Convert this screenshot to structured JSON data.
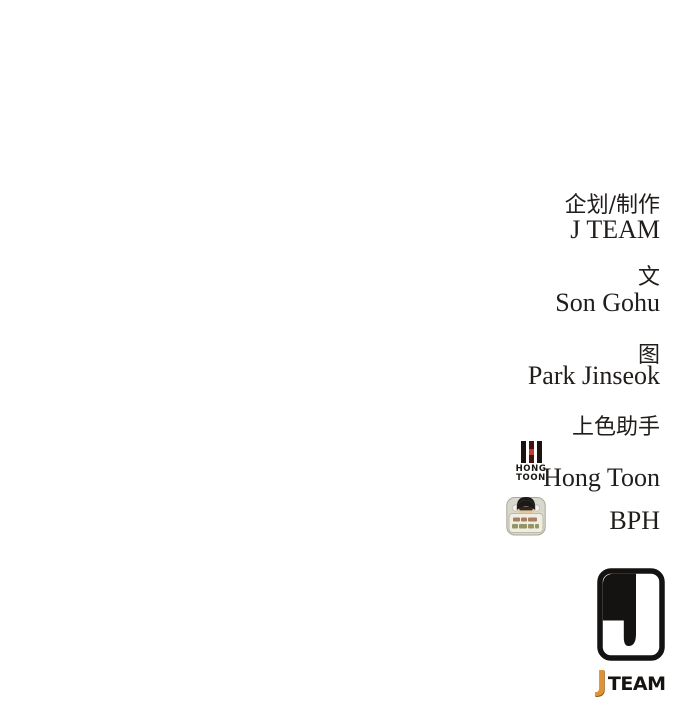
{
  "page": {
    "background": "#ffffff",
    "text_color": "#201d1b"
  },
  "credits": {
    "production_role": "企划/制作",
    "production_name": "J TEAM",
    "writer_role": "文",
    "writer_name": "Son Gohu",
    "artist_role": "图",
    "artist_name": "Park Jinseok",
    "coloring_role": "上色助手",
    "coloring_name_1": "Hong Toon",
    "coloring_name_2": "BPH"
  },
  "hongtoon_logo": {
    "line1": "HONG",
    "line2": "TOON",
    "bar_black": "#1b1410",
    "bar_red_dark": "#45130f",
    "bar_red_bright": "#c23b2d"
  },
  "jteam_logo": {
    "wordmark_j": "J",
    "wordmark_team": "TEAM",
    "j_color": "#dd9438",
    "mark_color": "#151311"
  }
}
